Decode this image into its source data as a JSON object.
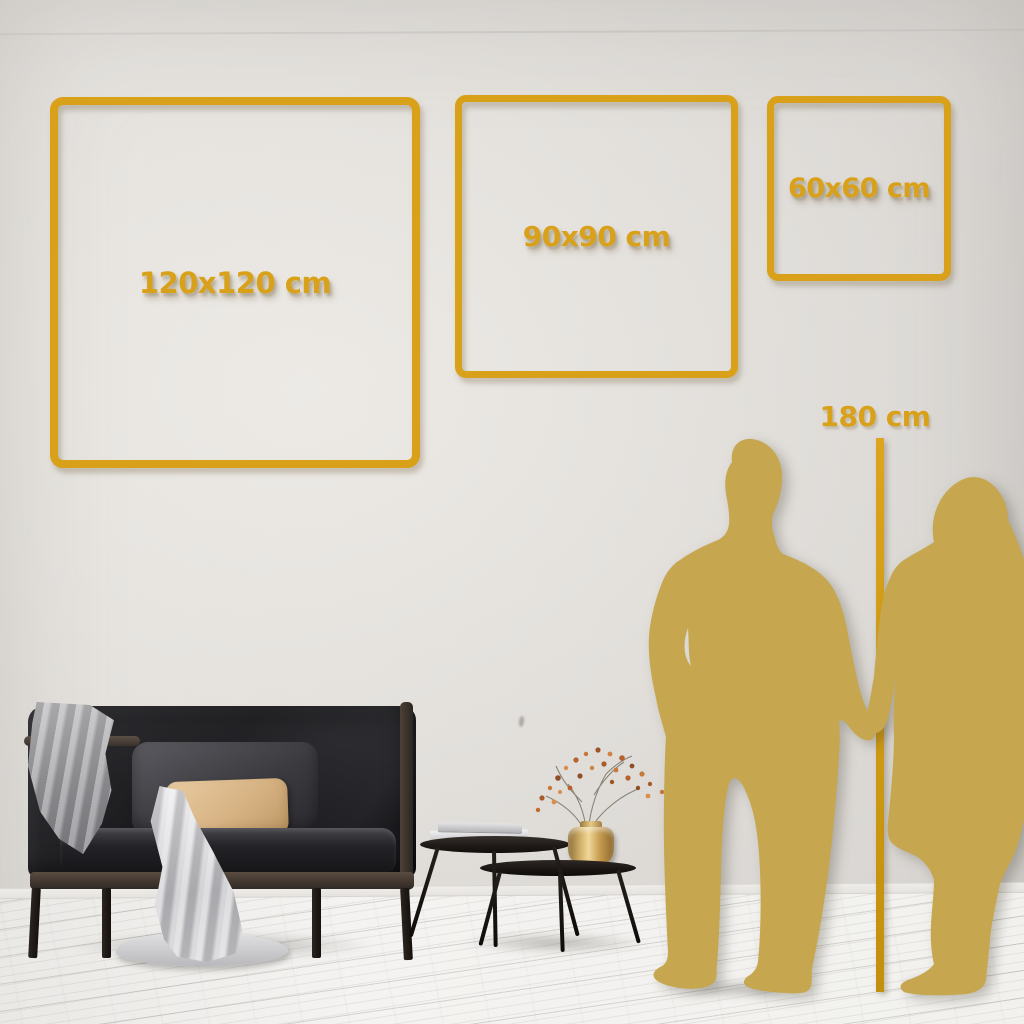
{
  "size_guide": {
    "frames": [
      {
        "id": "frame-120",
        "label": "120x120 cm"
      },
      {
        "id": "frame-90",
        "label": "90x90 cm"
      },
      {
        "id": "frame-60",
        "label": "60x60 cm"
      }
    ],
    "height_marker": {
      "label": "180 cm"
    }
  },
  "icons": {
    "couple_silhouette": "man-and-woman-holding-hands-silhouette"
  },
  "theme": {
    "accent_gold": "#d9a019",
    "silhouette_gold": "#c6a64e",
    "wall": "#dcd9d5",
    "floor": "#f3f2f0",
    "sofa_dark": "#1c1c1f",
    "pillow_tan": "#d7b384"
  }
}
